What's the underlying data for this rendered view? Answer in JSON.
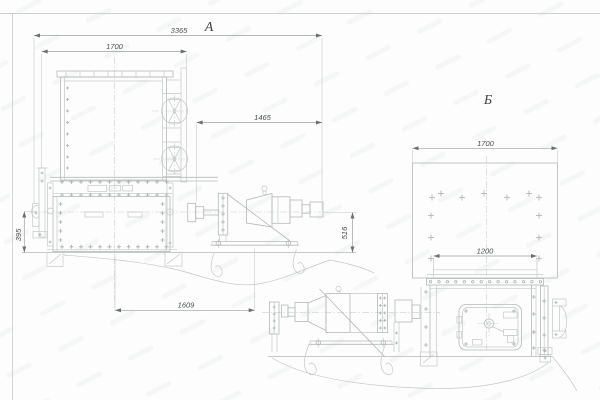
{
  "drawing": {
    "views": {
      "a": {
        "label": "А",
        "dimensions": {
          "overall_length": "3365",
          "hopper_width": "1700",
          "drive_span": "1465",
          "support_height": "395",
          "axis_height": "516",
          "drive_offset": "1609"
        }
      },
      "b": {
        "label": "Б",
        "dimensions": {
          "hopper_width": "1700",
          "outlet_width": "1200"
        }
      }
    },
    "colors": {
      "background": "#fdfdfd",
      "outline": "#b4b9b7",
      "detail": "#c3c8c6",
      "dimension_line": "#9aa09e",
      "arrow": "#6a706e",
      "text": "#4a4f4d"
    }
  }
}
